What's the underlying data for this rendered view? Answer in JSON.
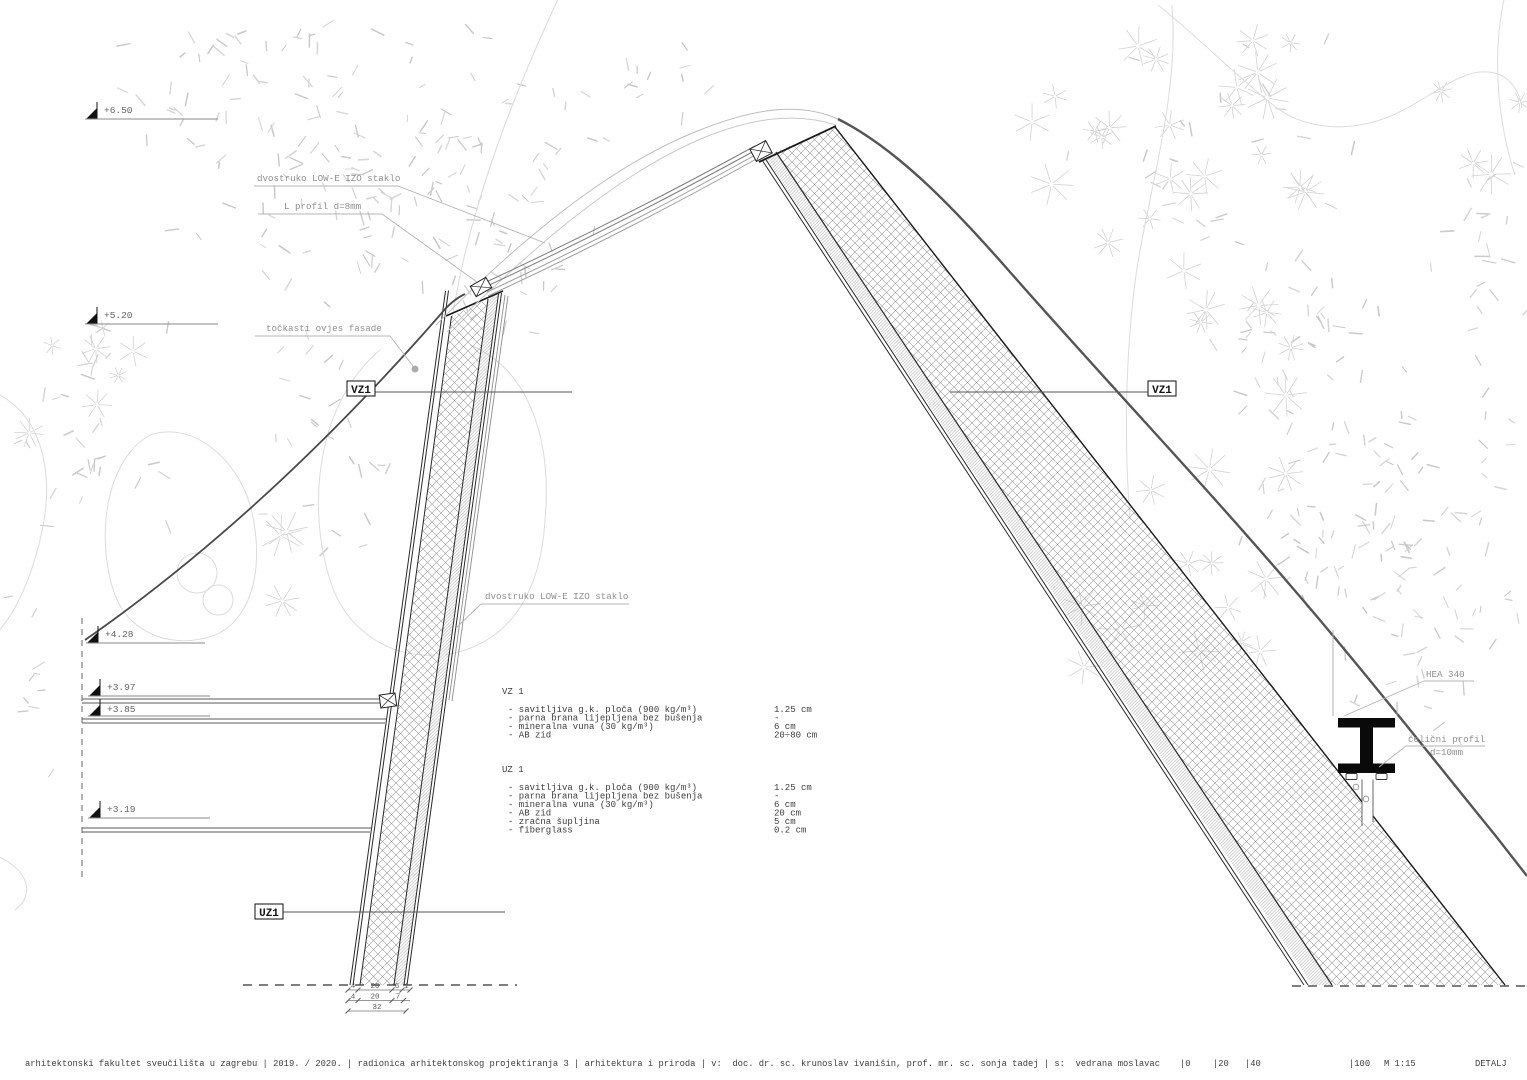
{
  "drawing": {
    "elevations": [
      {
        "label": "+6.50"
      },
      {
        "label": "+5.20"
      },
      {
        "label": "+4.28"
      },
      {
        "label": "+3.97"
      },
      {
        "label": "+3.85"
      },
      {
        "label": "+3.19"
      }
    ],
    "callouts": {
      "glass_top": "dvostruko LOW-E IZO staklo",
      "l_profil": "L profil d=8mm",
      "tockasti": "točkasti ovjes fasade",
      "glass_mid": "dvostruko LOW-E IZO staklo",
      "hea": "HEA 340",
      "celicni_1": "čelični profil",
      "celicni_2": "d=10mm"
    },
    "tags": {
      "vz1_left": "VZ1",
      "vz1_right": "VZ1",
      "uz1": "UZ1"
    }
  },
  "legend": {
    "vz1": {
      "title": "VZ 1",
      "items": [
        {
          "name": "- savitljiva g.k. ploča (900 kg/m³)",
          "value": "1.25 cm"
        },
        {
          "name": "- parna brana lijepljena bez bušenja",
          "value": "-"
        },
        {
          "name": "- mineralna vuna (30 kg/m³)",
          "value": "6 cm"
        },
        {
          "name": "- AB zid",
          "value": "20÷80 cm"
        }
      ]
    },
    "uz1": {
      "title": "UZ 1",
      "items": [
        {
          "name": "- savitljiva g.k. ploča (900 kg/m³)",
          "value": "1.25 cm"
        },
        {
          "name": "- parna brana lijepljena bez bušenja",
          "value": "-"
        },
        {
          "name": "- mineralna vuna (30 kg/m³)",
          "value": "6 cm"
        },
        {
          "name": "- AB zid",
          "value": "20 cm"
        },
        {
          "name": "- zračna šupljina",
          "value": "5 cm"
        },
        {
          "name": "- fiberglass",
          "value": "0.2 cm"
        }
      ]
    }
  },
  "dimensions": {
    "row1": [
      "4",
      "20",
      "6",
      "1"
    ],
    "row2": [
      "4",
      "20",
      "7"
    ],
    "row3": [
      "32"
    ]
  },
  "footer": {
    "info": "arhitektonski fakultet sveučilišta u zagrebu | 2019. / 2020. | radionica arhitektonskog projektiranja 3 | arhitektura i priroda | v:  doc. dr. sc. krunoslav ivanišin, prof. mr. sc. sonja tadej | s:  vedrana moslavac",
    "t0": "|0",
    "t20": "|20",
    "t40": "|40",
    "t100": "|100",
    "scale": "M 1:15",
    "sheet": "DETALJ"
  }
}
